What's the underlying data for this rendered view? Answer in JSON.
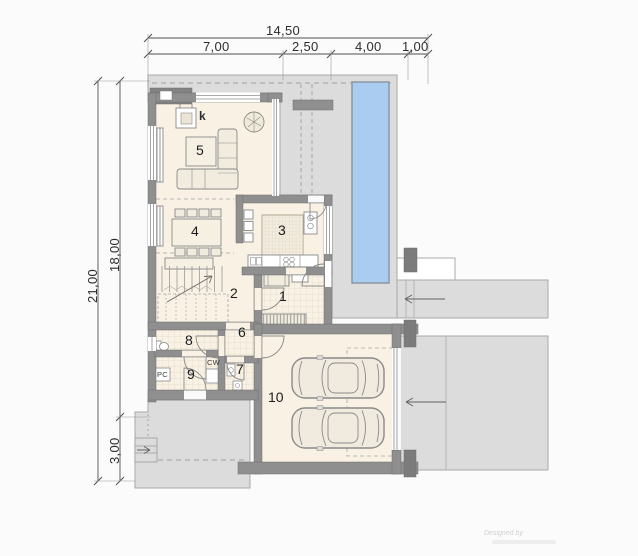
{
  "dimensions": {
    "top": {
      "total": "14,50",
      "seg1": "7,00",
      "seg2": "2,50",
      "seg3": "4,00",
      "seg4": "1,00"
    },
    "left": {
      "total": "21,00",
      "upper": "18,00",
      "lower": "3,00"
    }
  },
  "rooms": {
    "r1": "1",
    "r2": "2",
    "r3": "3",
    "r4": "4",
    "r5": "5",
    "r6": "6",
    "r7": "7",
    "r8": "8",
    "r9": "9",
    "r10": "10"
  },
  "equipment": {
    "fireplace": "k",
    "boiler": "PC",
    "water_heater": "CW"
  },
  "watermark": {
    "credit": "Designed by"
  },
  "colors": {
    "pool": "#a9ccf0",
    "terrace": "#dcdcdc",
    "wall": "#8f8f8f",
    "floor": "#f8f1e4"
  }
}
